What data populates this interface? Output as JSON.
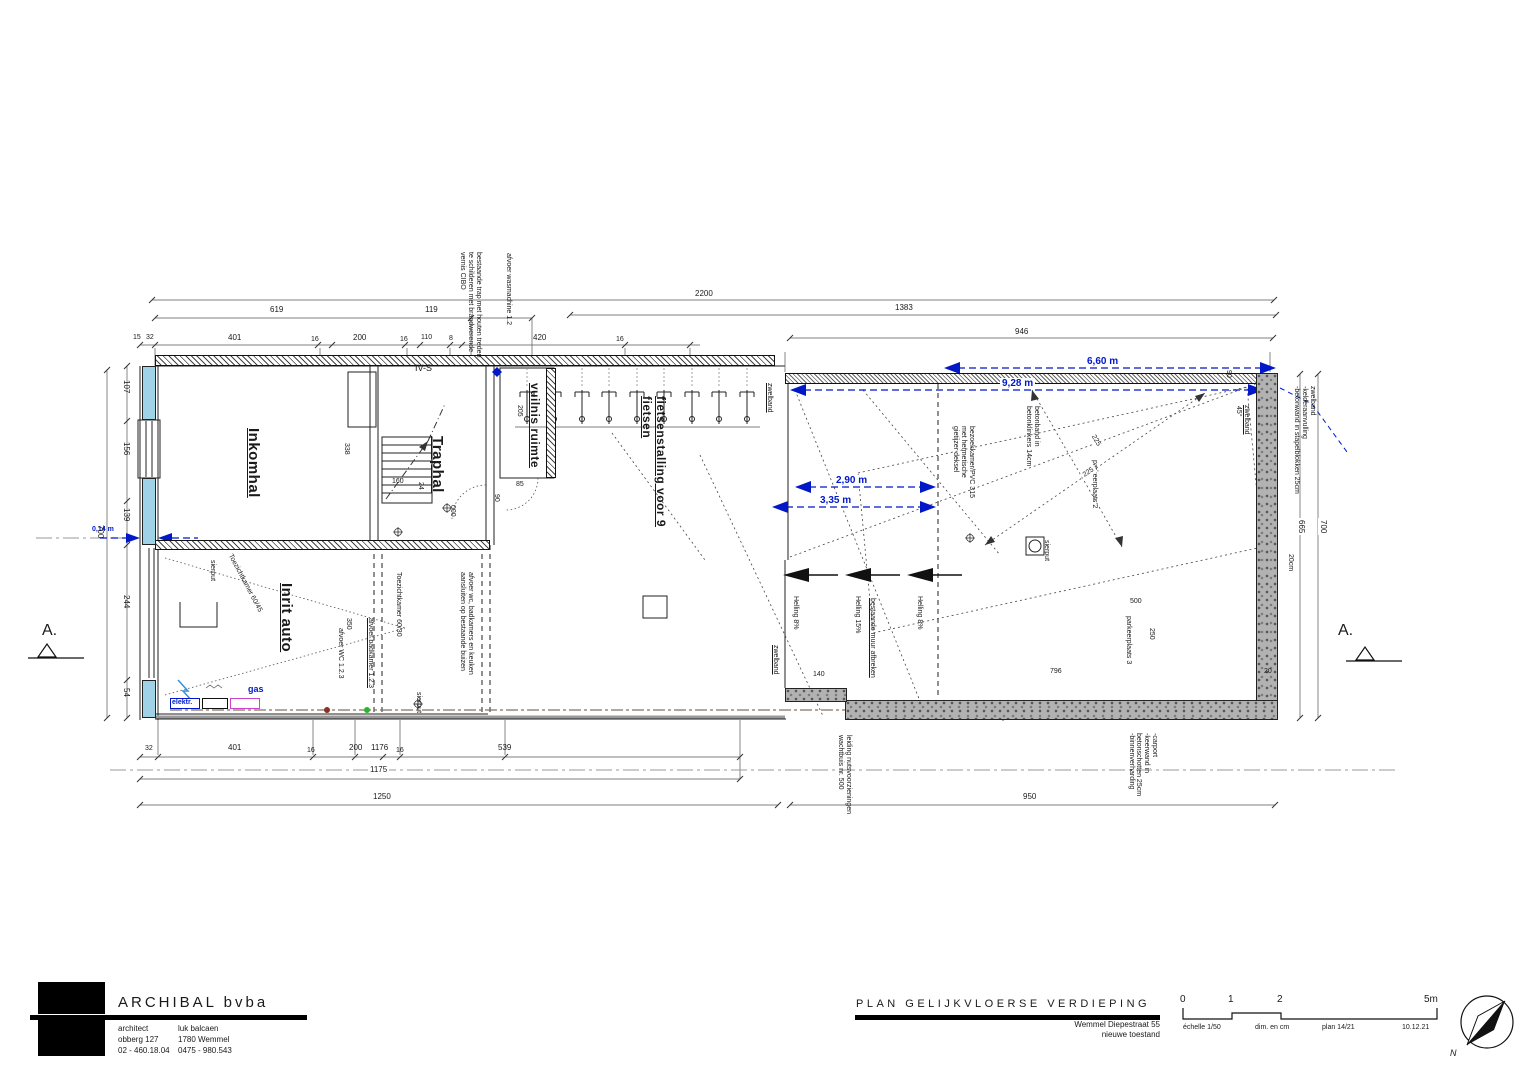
{
  "doc": {
    "plan_title": "PLAN GELIJKVLOERSE VERDIEPING",
    "address_line1": "Wemmel Diepestraat 55",
    "address_line2": "nieuwe toestand",
    "firm": "ARCHIBAL bvba",
    "col1": [
      "architect",
      "obberg 127",
      "02 - 460.18.04"
    ],
    "col2": [
      "luk balcaen",
      "1780 Wemmel",
      "0475 - 980.543"
    ],
    "scale": {
      "t0": "0",
      "t1": "1",
      "t2": "2",
      "t5": "5m",
      "echelle": "échelle 1/50",
      "dim": "dim. en cm",
      "plan": "plan 14/21",
      "date": "10.12.21"
    },
    "north": "N"
  },
  "section": {
    "a": "A."
  },
  "rooms": {
    "inkomhal": "Inkomhal",
    "traphal": "Traphal",
    "inrit": "Inrit auto",
    "vuilnis": "vuilnis ruimte",
    "fietsen": "fietsenstalling voor 9\nfietsen"
  },
  "notes": {
    "ivs": "IV-S",
    "cibo": "bestaande trap met houten treden\nte schilderen met brandwerende\nvernis CIBO",
    "wasmachine": "afvoer wasmachine 1.2",
    "zwelband": "zwelband",
    "toez6045": "Toezichtkamer 60/45",
    "toez6030": "Toezichtkamer 60/30",
    "afvoer_wc": "afvoer WC 1.2.3",
    "afvoer_bad": "afvoer badkamer 1.2.3",
    "afvoer_keuken": "afvoer wc, badkamers en keuken\naansluiten op bestaande buizen",
    "helling8": "Helling 8%",
    "helling15": "Helling 15%",
    "bestaande_muur": "bestaande muur afbreken",
    "betonband": "betonband in\nbetonklinkers 14cm",
    "bezoekkamer": "bezoekkamer/PVC 315\nmet hermetische\ngietijzer deksel",
    "parkeer2": "parkeerplaats 2",
    "parkeer3": "parkeerplaats 3",
    "rightwall": "zwelband\n-kelderaanvulling\n-betonwand in stapelblokken 25cm",
    "bottomright": "-carport\n-keerwand in\nbetonschotten 25cm\n-binnenverharding",
    "bottomcenter": "leiding nutsvoorzieningen\nwachtbuis nr. 500",
    "sierput": "sierput",
    "gas": "gas",
    "elektr": "elektr.",
    "level": "000"
  },
  "dims": {
    "blue": {
      "d660": "6,60 m",
      "d928": "9,28 m",
      "d290": "2,90 m",
      "d335": "3,35 m",
      "d014": "0,14 m"
    },
    "top": {
      "total": "2200",
      "a": "619",
      "b": "119",
      "c": "1383",
      "d": "946",
      "r": [
        "15",
        "32",
        "401",
        "16",
        "200",
        "16",
        "110",
        "8",
        "420",
        "16"
      ]
    },
    "bottom": {
      "r": [
        "32",
        "401",
        "16",
        "200",
        "1176",
        "16",
        "539"
      ],
      "sub": "1175",
      "total": "1250",
      "right": "950"
    },
    "left": {
      "total": "700",
      "segs": [
        "107",
        "156",
        "139",
        "244",
        "54"
      ]
    },
    "right": {
      "a": "665",
      "b": "700",
      "wall": "20cm",
      "w20": "20"
    },
    "inner": {
      "i338": "338",
      "i205": "205",
      "i85": "85",
      "i90": "90",
      "i160": "160",
      "i24": "24",
      "i350": "350",
      "i140": "140",
      "i500": "500",
      "i250": "250",
      "i796": "796",
      "i225": "225",
      "i90b": "90",
      "i45": "45°"
    }
  }
}
